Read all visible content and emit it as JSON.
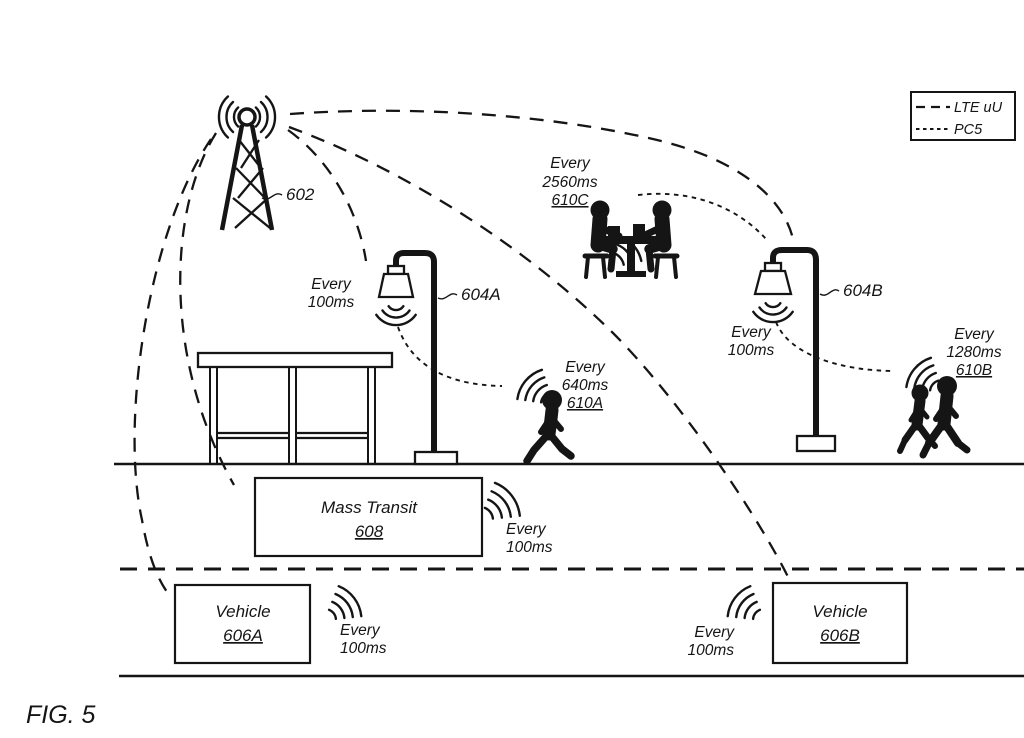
{
  "figure": {
    "caption": "FIG. 5"
  },
  "colors": {
    "ink": "#151515",
    "background": "#ffffff"
  },
  "legend": {
    "items": [
      {
        "label": "LTE uU",
        "line_style": "long-dash"
      },
      {
        "label": "PC5",
        "line_style": "short-dash"
      }
    ]
  },
  "nodes": {
    "tower": {
      "ref": "602",
      "icon": "cell-tower-icon"
    },
    "light_a": {
      "ref": "604A",
      "icon": "street-light-icon",
      "beacon": {
        "line1": "Every",
        "line2": "100ms"
      }
    },
    "light_b": {
      "ref": "604B",
      "icon": "street-light-icon",
      "beacon": {
        "line1": "Every",
        "line2": "100ms"
      }
    },
    "table_group": {
      "ref": "610C",
      "icon": "people-at-table-icon",
      "beacon": {
        "line1": "Every",
        "line2": "2560ms"
      }
    },
    "ped_a": {
      "ref": "610A",
      "icon": "pedestrian-icon",
      "beacon": {
        "line1": "Every",
        "line2": "640ms"
      }
    },
    "ped_b": {
      "ref": "610B",
      "icon": "pedestrian-pair-icon",
      "beacon": {
        "line1": "Every",
        "line2": "1280ms"
      }
    },
    "mass_transit": {
      "label": "Mass Transit",
      "ref": "608",
      "beacon": {
        "line1": "Every",
        "line2": "100ms"
      }
    },
    "vehicle_a": {
      "label": "Vehicle",
      "ref": "606A",
      "beacon": {
        "line1": "Every",
        "line2": "100ms"
      }
    },
    "vehicle_b": {
      "label": "Vehicle",
      "ref": "606B",
      "beacon": {
        "line1": "Every",
        "line2": "100ms"
      }
    }
  }
}
